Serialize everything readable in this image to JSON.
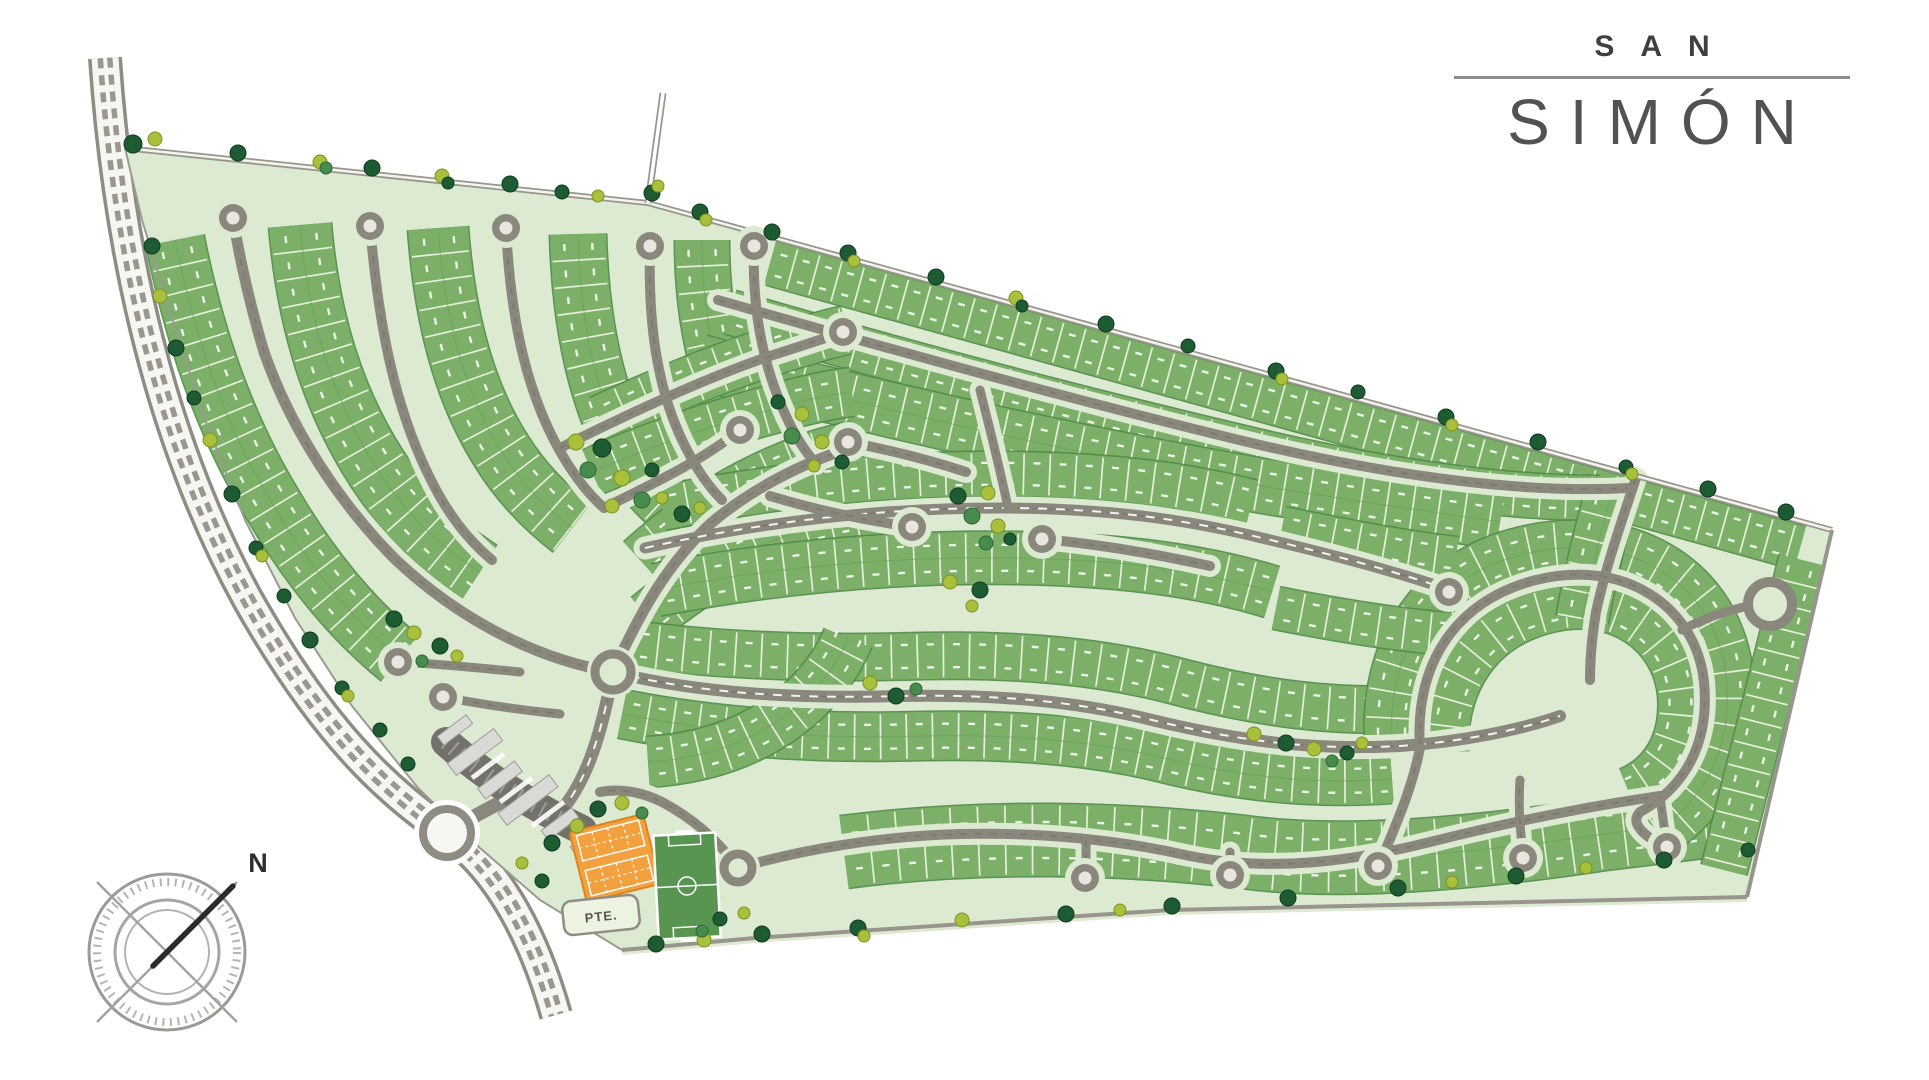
{
  "logo": {
    "top": "SAN",
    "bottom": "SIMÓN"
  },
  "compass": {
    "label": "N",
    "cx": 167,
    "cy": 952
  },
  "labels": {
    "gate_tag": "PTE."
  },
  "colors": {
    "site_fill": "#dcead2",
    "lot_green": "#7cb068",
    "lot_edge": "#4e8a47",
    "lot_tick": "#ecf3e2",
    "road_gray": "#8a887d",
    "road_dark_dash": "#6f6e64",
    "boundary_gray": "#98968c",
    "highway_gray": "#8f8d82",
    "highway_light": "#f6f6f2",
    "bulb_center": "#e8e6de",
    "tree_d": "#1d5c33",
    "tree_g": "#478c4c",
    "tree_l": "#a8c03c",
    "court_orange": "#f2a13e",
    "court_edge": "#dd861e",
    "field_green": "#579551",
    "building_gray": "#d9d9d6",
    "plaza_gray": "#73716a",
    "logo_text": "#4c4c4c"
  },
  "map": {
    "site": "M125,148 L648,203 L1832,530 L1747,897 L1170,910 L755,938 L622,950 L540,900 L480,848 L418,788 L352,706 L295,618 L245,520 L205,420 L172,318 L142,220 Z",
    "highway": {
      "d": "M105,58 C118,250 160,440 248,600 C330,745 395,795 447,833 C500,870 535,940 556,1015",
      "roundabout": [
        447,
        833,
        24
      ]
    },
    "entry_spur": "M447,833 C470,818 492,806 518,794",
    "boundary_top": "M125,148 L648,203 L1832,530",
    "boundary_right": "M1832,530 L1747,897",
    "boundary_bottom": "M1747,897 L1170,910 L755,938 L622,950",
    "boundary_west": "M125,148 L142,220 L172,318 L205,420 L245,520 L295,618 L352,706 L418,788 L480,848 L540,900 L622,950",
    "access_track": "M648,203 L663,93",
    "roads": [
      {
        "d": "M613,672 C540,660 462,622 396,560 C342,506 292,432 264,352 C252,312 240,262 233,218",
        "w": 11
      },
      {
        "d": "M370,226 C378,316 392,404 432,482 C448,514 468,540 492,560",
        "w": 10
      },
      {
        "d": "M506,228 C510,306 522,380 556,444 C570,470 586,492 604,508",
        "w": 10
      },
      {
        "d": "M650,246 C648,320 656,390 686,448 C696,468 708,486 722,500",
        "w": 10
      },
      {
        "d": "M754,246 C752,306 762,364 786,416 C794,434 804,450 816,464",
        "w": 10
      },
      {
        "d": "M560,448 C620,418 700,380 770,356 C795,348 820,340 843,332",
        "w": 10
      },
      {
        "d": "M604,508 C650,485 700,462 740,430",
        "w": 10
      },
      {
        "d": "M848,442 C890,450 930,460 966,472",
        "w": 10
      },
      {
        "d": "M613,672 C642,608 668,564 710,524 C750,490 800,464 850,448",
        "w": 11
      },
      {
        "d": "M645,548 C760,522 880,508 1000,508 C1100,508 1180,518 1262,538 C1330,554 1390,570 1444,588",
        "w": 11,
        "dash": true
      },
      {
        "d": "M613,672 C700,694 800,699 900,696 C1000,694 1080,702 1152,720 C1252,744 1322,750 1400,746 C1460,742 1520,730 1560,716",
        "w": 12,
        "dash": true
      },
      {
        "d": "M912,527 C864,520 816,510 770,496",
        "w": 10
      },
      {
        "d": "M1042,539 C1098,544 1156,554 1210,566",
        "w": 10
      },
      {
        "d": "M398,662 C440,664 480,668 520,672",
        "w": 9
      },
      {
        "d": "M443,697 C480,704 520,710 560,714",
        "w": 9
      },
      {
        "d": "M560,812 C588,780 602,730 613,672",
        "w": 13,
        "dash": true
      },
      {
        "d": "M718,300 C900,352 1080,402 1260,445 C1390,475 1520,494 1628,488",
        "w": 10
      },
      {
        "d": "M1636,478 C1622,520 1606,566 1596,612 C1592,636 1590,658 1590,680",
        "w": 10
      },
      {
        "d": "M738,868 C800,850 880,836 960,834 C1040,832 1120,840 1190,856 C1270,872 1350,862 1430,842 C1510,822 1590,806 1660,796",
        "w": 10
      },
      {
        "d": "M1086,840 L1086,872",
        "w": 9
      },
      {
        "d": "M1230,852 L1230,871",
        "w": 9
      },
      {
        "d": "M1382,858 C1398,820 1412,788 1420,748 C1414,664 1456,600 1536,580 C1624,558 1696,606 1704,682 C1710,744 1684,788 1640,812 C1628,824 1648,838 1662,845",
        "w": 10
      },
      {
        "d": "M1523,854 C1520,830 1518,806 1520,780",
        "w": 9
      },
      {
        "d": "M1667,843 C1664,828 1662,812 1660,796",
        "w": 9
      },
      {
        "d": "M738,868 C716,838 692,818 662,802 C642,792 620,788 600,792",
        "w": 10
      },
      {
        "d": "M980,390 C990,430 1000,468 1008,508",
        "w": 9
      }
    ],
    "blocks": [
      {
        "d": "M175,240 C194,335 224,426 276,510 C308,564 350,618 400,658",
        "w": 58
      },
      {
        "d": "M300,225 C308,318 332,405 386,482 C412,520 446,550 480,572",
        "w": 62
      },
      {
        "d": "M438,228 C444,312 462,390 502,452 C522,484 546,508 572,528",
        "w": 60
      },
      {
        "d": "M578,234 C580,312 592,382 620,440 C636,472 656,496 678,512",
        "w": 56
      },
      {
        "d": "M702,240 C702,304 712,364 736,416",
        "w": 54
      },
      {
        "d": "M770,263 L1800,548",
        "w": 44,
        "step": 23
      },
      {
        "d": "M730,312 C900,362 1080,410 1260,452 C1380,480 1500,498 1600,498",
        "w": 44
      },
      {
        "d": "M700,362 C880,410 1060,450 1240,482 C1330,498 1420,510 1500,522",
        "w": 54
      },
      {
        "d": "M600,420 C660,392 732,362 802,342 C818,337 832,333 846,330",
        "w": 48
      },
      {
        "d": "M592,472 C652,446 722,422 792,404 C814,398 834,394 852,392",
        "w": 48
      },
      {
        "d": "M640,560 C682,522 732,488 792,464 C814,455 834,449 854,446",
        "w": 48
      },
      {
        "d": "M648,618 C692,582 742,550 802,530 C832,520 862,514 892,510",
        "w": 52
      },
      {
        "d": "M662,508 C780,484 900,472 1020,474 C1112,476 1182,484 1252,502",
        "w": 44
      },
      {
        "d": "M656,590 C780,566 900,556 1020,558 C1120,560 1200,570 1272,592",
        "w": 52
      },
      {
        "d": "M632,644 C722,656 822,659 922,656 C1022,654 1102,662 1172,680 C1262,704 1332,712 1402,709",
        "w": 46
      },
      {
        "d": "M622,714 C722,734 822,739 922,736 C1022,734 1102,742 1172,760 C1252,779 1322,784 1392,779",
        "w": 48
      },
      {
        "d": "M648,762 C710,758 762,738 802,702 C822,684 838,662 848,638",
        "w": 50
      },
      {
        "d": "M844,852 C984,834 1124,838 1244,852 C1344,866 1484,852 1604,834 C1654,828 1704,822 1740,817",
        "w": 72,
        "step": 27
      },
      {
        "d": "M1392,744 C1386,652 1432,576 1524,554 C1630,528 1716,584 1726,676 C1734,750 1702,804 1652,834",
        "w": 54
      },
      {
        "d": "M1446,752 C1444,682 1480,626 1550,610 C1618,594 1674,634 1680,694 C1684,742 1662,776 1628,790",
        "w": 44
      },
      {
        "d": "M1802,560 L1724,870",
        "w": 46,
        "step": 24
      },
      {
        "d": "M1282,528 C1342,540 1402,552 1456,558",
        "w": 42
      },
      {
        "d": "M1276,608 C1336,620 1396,630 1450,634",
        "w": 42
      },
      {
        "d": "M1612,492 C1600,534 1590,576 1582,620",
        "w": 52
      }
    ],
    "bulbs": [
      [
        233,
        218
      ],
      [
        370,
        226
      ],
      [
        506,
        228
      ],
      [
        650,
        246
      ],
      [
        754,
        246
      ],
      [
        843,
        332
      ],
      [
        740,
        430
      ],
      [
        848,
        442
      ],
      [
        912,
        527
      ],
      [
        1042,
        539
      ],
      [
        398,
        662
      ],
      [
        443,
        697
      ],
      [
        1449,
        592
      ],
      [
        1085,
        878
      ],
      [
        1230,
        875
      ],
      [
        1378,
        866
      ],
      [
        1523,
        858
      ],
      [
        1667,
        847
      ]
    ],
    "roundabouts": [
      [
        613,
        672,
        18
      ],
      [
        738,
        868,
        14
      ]
    ],
    "loop_court": {
      "cx": 1770,
      "cy": 604,
      "r": 22,
      "stem": "M1748,606 C1722,612 1700,620 1682,630"
    },
    "trees": [
      [
        133,
        144,
        9,
        "d"
      ],
      [
        155,
        139,
        7,
        "l"
      ],
      [
        238,
        153,
        8,
        "d"
      ],
      [
        320,
        162,
        7,
        "l"
      ],
      [
        326,
        168,
        6,
        "g"
      ],
      [
        372,
        168,
        8,
        "d"
      ],
      [
        442,
        176,
        7,
        "l"
      ],
      [
        448,
        183,
        6,
        "d"
      ],
      [
        510,
        184,
        8,
        "d"
      ],
      [
        562,
        192,
        7,
        "d"
      ],
      [
        598,
        196,
        6,
        "l"
      ],
      [
        652,
        193,
        8,
        "d"
      ],
      [
        658,
        186,
        6,
        "l"
      ],
      [
        700,
        212,
        8,
        "d"
      ],
      [
        706,
        220,
        6,
        "l"
      ],
      [
        772,
        232,
        8,
        "d"
      ],
      [
        848,
        253,
        8,
        "d"
      ],
      [
        854,
        261,
        6,
        "l"
      ],
      [
        936,
        277,
        8,
        "d"
      ],
      [
        1016,
        298,
        7,
        "l"
      ],
      [
        1022,
        306,
        6,
        "d"
      ],
      [
        1106,
        324,
        8,
        "d"
      ],
      [
        1188,
        346,
        7,
        "d"
      ],
      [
        1276,
        371,
        8,
        "d"
      ],
      [
        1282,
        379,
        6,
        "l"
      ],
      [
        1358,
        392,
        7,
        "d"
      ],
      [
        1446,
        417,
        8,
        "d"
      ],
      [
        1452,
        425,
        6,
        "l"
      ],
      [
        1538,
        442,
        8,
        "d"
      ],
      [
        1626,
        467,
        7,
        "d"
      ],
      [
        1632,
        474,
        6,
        "l"
      ],
      [
        1708,
        489,
        8,
        "d"
      ],
      [
        1786,
        512,
        8,
        "d"
      ],
      [
        152,
        246,
        8,
        "d"
      ],
      [
        160,
        296,
        7,
        "l"
      ],
      [
        176,
        348,
        8,
        "d"
      ],
      [
        194,
        398,
        7,
        "d"
      ],
      [
        210,
        440,
        7,
        "l"
      ],
      [
        232,
        494,
        8,
        "d"
      ],
      [
        256,
        548,
        7,
        "d"
      ],
      [
        262,
        556,
        6,
        "l"
      ],
      [
        284,
        596,
        7,
        "d"
      ],
      [
        310,
        640,
        8,
        "d"
      ],
      [
        342,
        688,
        7,
        "d"
      ],
      [
        348,
        696,
        6,
        "l"
      ],
      [
        380,
        730,
        7,
        "d"
      ],
      [
        408,
        764,
        7,
        "d"
      ],
      [
        656,
        944,
        8,
        "d"
      ],
      [
        704,
        940,
        7,
        "l"
      ],
      [
        762,
        934,
        8,
        "d"
      ],
      [
        858,
        928,
        8,
        "d"
      ],
      [
        864,
        936,
        6,
        "l"
      ],
      [
        962,
        920,
        7,
        "l"
      ],
      [
        1066,
        914,
        8,
        "d"
      ],
      [
        1120,
        910,
        6,
        "l"
      ],
      [
        1172,
        906,
        8,
        "d"
      ],
      [
        1288,
        898,
        8,
        "d"
      ],
      [
        1398,
        888,
        8,
        "d"
      ],
      [
        1452,
        882,
        6,
        "l"
      ],
      [
        1516,
        876,
        8,
        "d"
      ],
      [
        1586,
        868,
        6,
        "l"
      ],
      [
        1664,
        860,
        8,
        "d"
      ],
      [
        1748,
        850,
        7,
        "d"
      ],
      [
        576,
        442,
        8,
        "l"
      ],
      [
        602,
        448,
        9,
        "d"
      ],
      [
        588,
        470,
        8,
        "g"
      ],
      [
        622,
        478,
        8,
        "l"
      ],
      [
        652,
        470,
        7,
        "d"
      ],
      [
        642,
        500,
        8,
        "g"
      ],
      [
        612,
        506,
        7,
        "l"
      ],
      [
        662,
        498,
        6,
        "l"
      ],
      [
        682,
        514,
        8,
        "d"
      ],
      [
        700,
        508,
        6,
        "l"
      ],
      [
        778,
        402,
        7,
        "d"
      ],
      [
        802,
        414,
        7,
        "l"
      ],
      [
        792,
        436,
        8,
        "g"
      ],
      [
        822,
        442,
        7,
        "l"
      ],
      [
        842,
        462,
        7,
        "d"
      ],
      [
        814,
        466,
        6,
        "l"
      ],
      [
        958,
        496,
        8,
        "d"
      ],
      [
        988,
        493,
        7,
        "l"
      ],
      [
        972,
        516,
        8,
        "g"
      ],
      [
        998,
        526,
        7,
        "l"
      ],
      [
        986,
        543,
        7,
        "g"
      ],
      [
        950,
        582,
        7,
        "l"
      ],
      [
        980,
        590,
        8,
        "d"
      ],
      [
        972,
        606,
        6,
        "l"
      ],
      [
        1010,
        539,
        6,
        "d"
      ],
      [
        1254,
        734,
        7,
        "l"
      ],
      [
        1286,
        743,
        8,
        "d"
      ],
      [
        1314,
        749,
        7,
        "l"
      ],
      [
        1347,
        753,
        7,
        "d"
      ],
      [
        1332,
        761,
        6,
        "g"
      ],
      [
        1362,
        743,
        6,
        "l"
      ],
      [
        394,
        619,
        8,
        "d"
      ],
      [
        414,
        633,
        7,
        "l"
      ],
      [
        440,
        646,
        8,
        "d"
      ],
      [
        422,
        661,
        6,
        "g"
      ],
      [
        457,
        656,
        6,
        "l"
      ],
      [
        598,
        809,
        8,
        "d"
      ],
      [
        622,
        803,
        7,
        "l"
      ],
      [
        642,
        813,
        6,
        "g"
      ],
      [
        577,
        826,
        7,
        "l"
      ],
      [
        552,
        843,
        8,
        "d"
      ],
      [
        522,
        863,
        6,
        "l"
      ],
      [
        542,
        881,
        7,
        "d"
      ],
      [
        720,
        919,
        7,
        "d"
      ],
      [
        744,
        913,
        6,
        "l"
      ],
      [
        702,
        931,
        6,
        "g"
      ],
      [
        870,
        683,
        7,
        "l"
      ],
      [
        896,
        696,
        8,
        "d"
      ],
      [
        916,
        689,
        6,
        "g"
      ]
    ],
    "landmarks": {
      "gate": {
        "plaza": "M446,742 C480,772 520,800 582,830",
        "angle": -37,
        "buildings": [
          [
            475,
            752,
            58,
            15
          ],
          [
            455,
            730,
            36,
            11
          ],
          [
            500,
            780,
            46,
            13
          ],
          [
            528,
            800,
            64,
            15
          ],
          [
            560,
            824,
            38,
            12
          ],
          [
            585,
            842,
            30,
            10
          ]
        ],
        "strips": [
          [
            488,
            766,
            40,
            5
          ],
          [
            516,
            790,
            40,
            5
          ],
          [
            548,
            814,
            40,
            5
          ]
        ]
      },
      "courts": {
        "cx": 615,
        "cy": 858,
        "w": 76,
        "h": 72,
        "angle": -14
      },
      "field": {
        "cx": 687,
        "cy": 886,
        "w": 62,
        "h": 104,
        "angle": -3
      },
      "gate_tag": {
        "cx": 601,
        "cy": 915,
        "w": 76,
        "h": 34,
        "angle": -6
      }
    }
  }
}
